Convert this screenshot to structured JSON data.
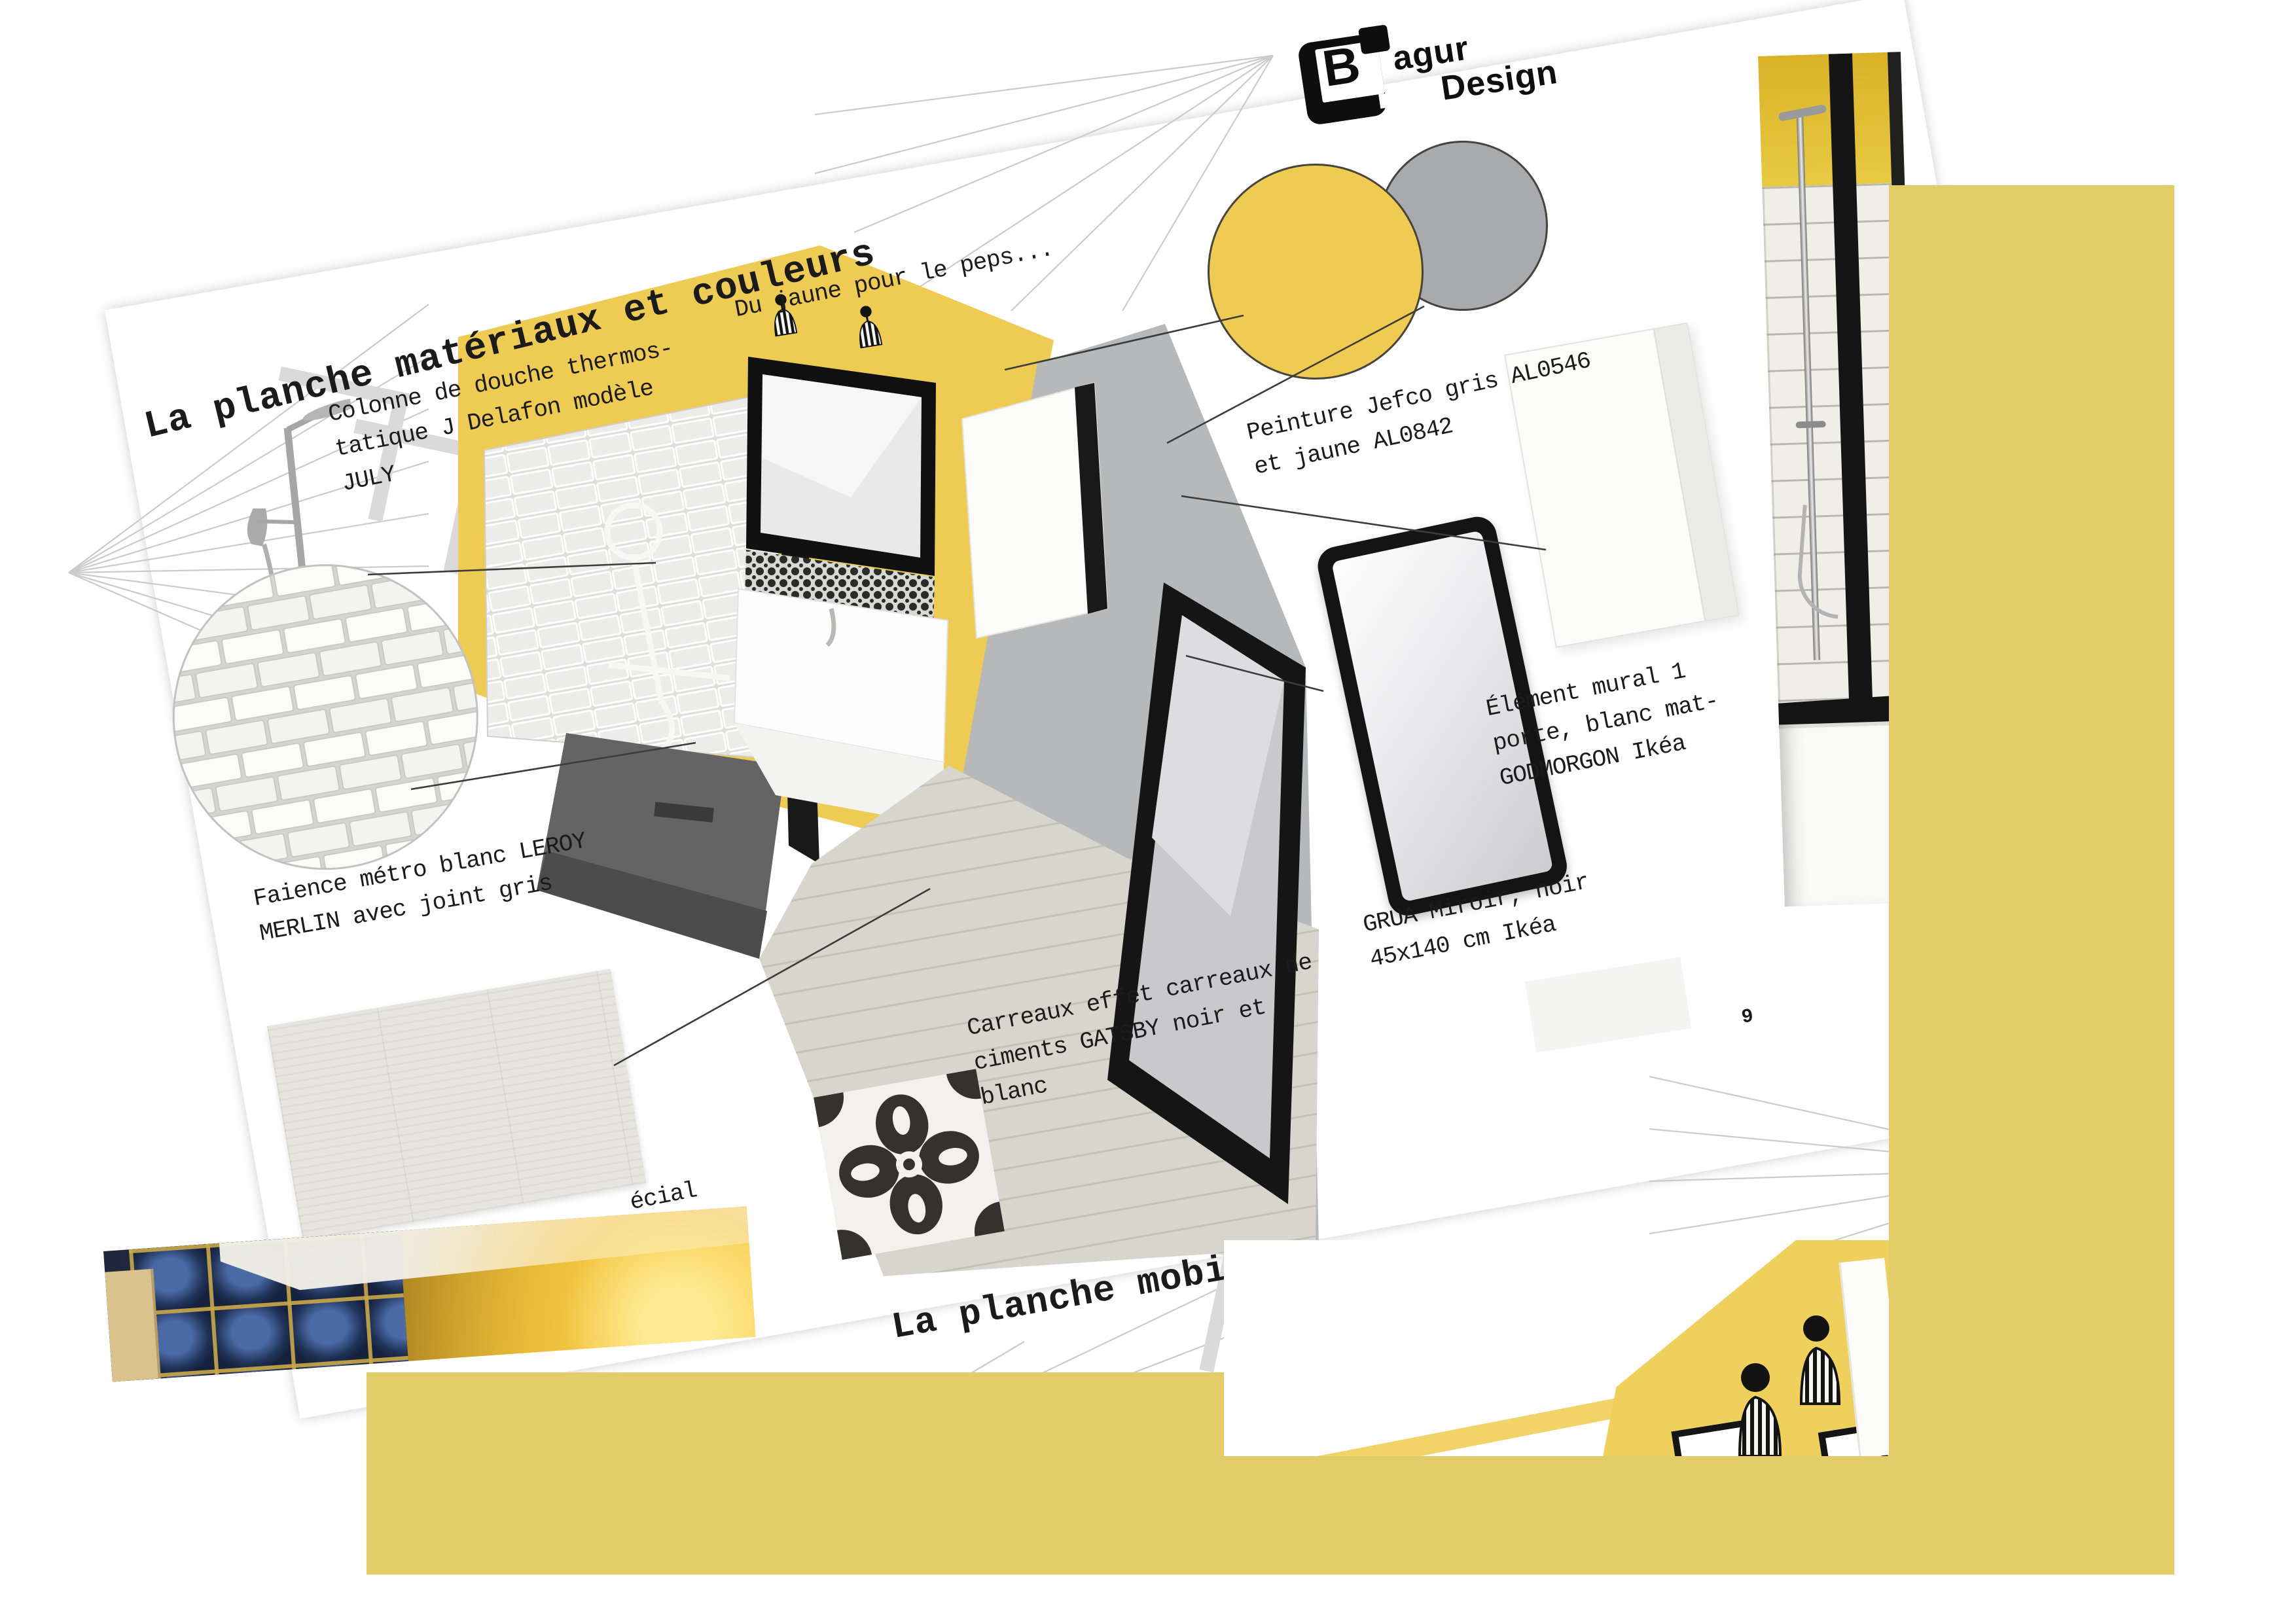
{
  "document": {
    "title": "La planche matériaux et couleurs",
    "next_section_title": "La planche mobiliers",
    "page_number": "9"
  },
  "logo": {
    "b": "B",
    "name_top": "agur",
    "name_bottom": "Design"
  },
  "palette": {
    "accent_yellow": "#efcb52",
    "block_yellow": "#e2cd68",
    "swatch_gray": "#a8aaad"
  },
  "labels": {
    "accent": "Du jaune pour le peps...",
    "paint": "Peinture Jefco gris AL0546\net jaune AL0842",
    "shower_column": "Colonne de douche thermos-\ntatique J Delafon modèle\nJULY",
    "metro_tiles": "Faience métro blanc LEROY\nMERLIN avec joint gris",
    "floor_partial": "écial",
    "cement_tiles": "Carreaux effet carreaux de\nciments GATSBY noir et\nblanc",
    "mirror": "GRUA Miroir, noir\n45x140 cm Ikéa",
    "wall_unit": "Élément mural 1\nporte, blanc mat-\nGODMORGON Ikéa"
  }
}
